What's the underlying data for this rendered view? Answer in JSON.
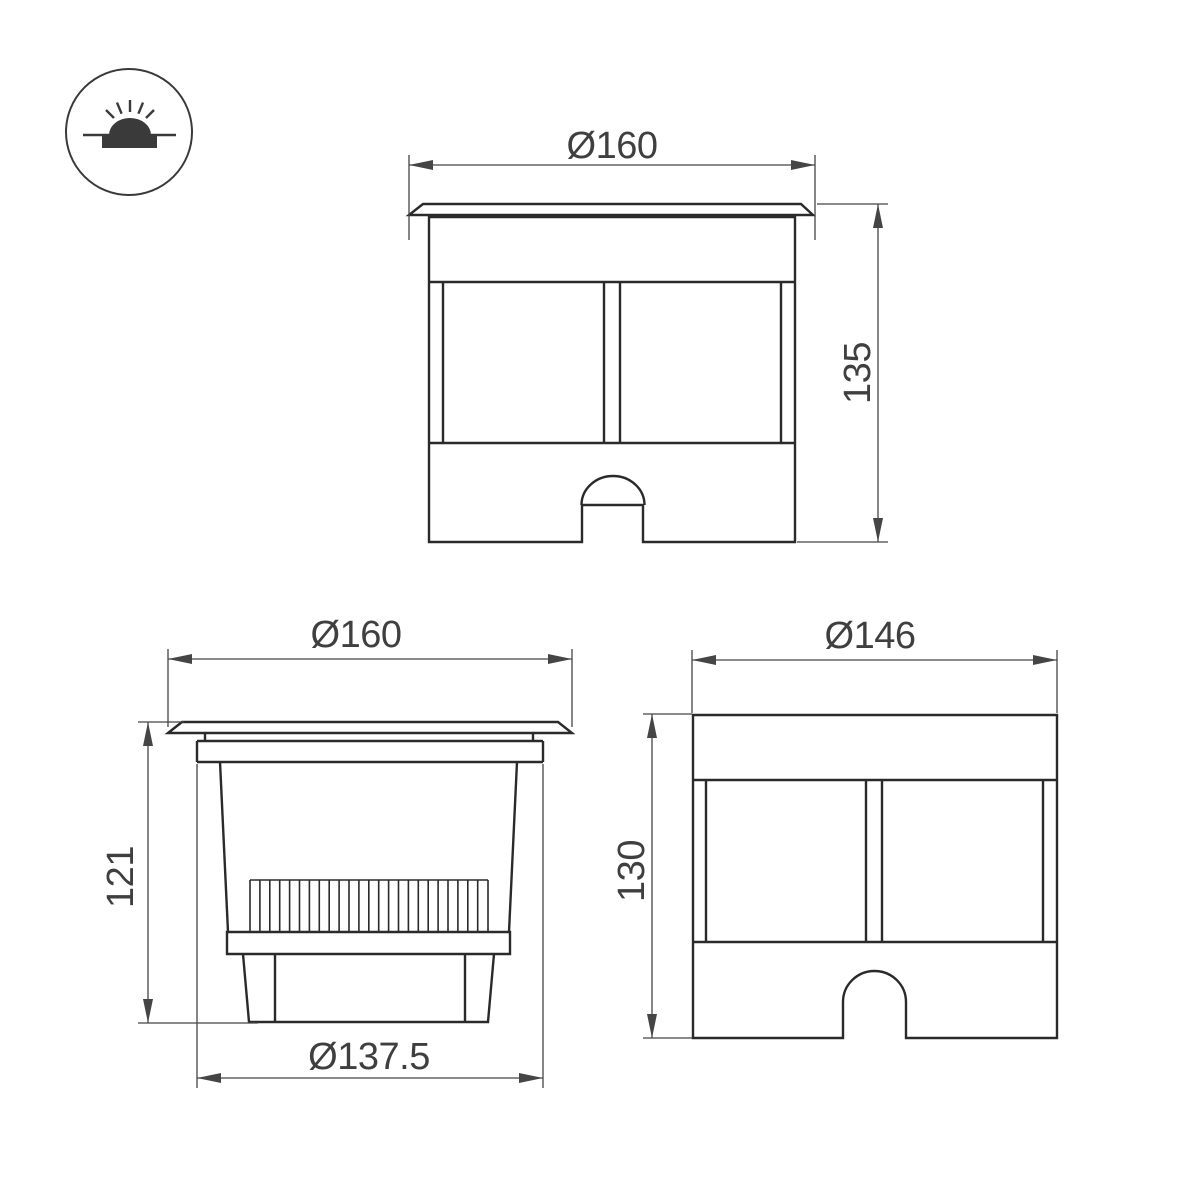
{
  "colors": {
    "background": "#ffffff",
    "outline": "#2a2a2a",
    "dimension": "#454545",
    "text": "#3f3f3f",
    "icon_fill": "#3a3a3a"
  },
  "legend_icon": {
    "name": "recessed-ground-light-symbol"
  },
  "views": {
    "front": {
      "title": "front view with trim flange",
      "width_label": "Ø160",
      "height_label": "135"
    },
    "side": {
      "title": "side view of recessed housing",
      "width_label": "Ø160",
      "height_label": "121",
      "body_diameter_label": "Ø137.5"
    },
    "body": {
      "title": "front view of housing without flange",
      "width_label": "Ø146",
      "height_label": "130"
    }
  }
}
